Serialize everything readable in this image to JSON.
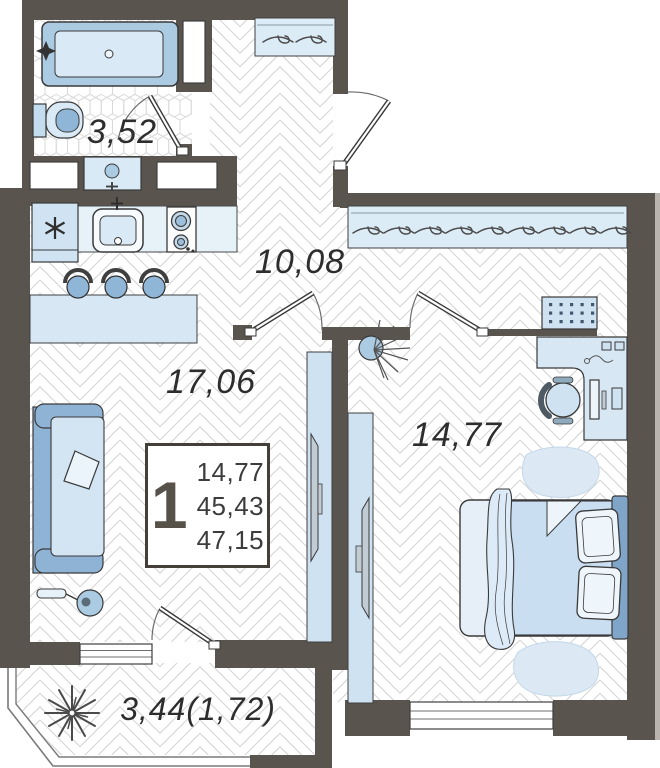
{
  "plan": {
    "rooms": [
      {
        "name": "bathroom",
        "area_label": "3,52"
      },
      {
        "name": "hallway",
        "area_label": "10,08"
      },
      {
        "name": "living-room",
        "area_label": "17,06"
      },
      {
        "name": "bedroom",
        "area_label": "14,77"
      },
      {
        "name": "balcony",
        "area_label": "3,44(1,72)"
      }
    ],
    "info_box": {
      "rooms_count": "1",
      "values": [
        "14,77",
        "45,43",
        "47,15"
      ]
    },
    "colors": {
      "wall": "#59544e",
      "furniture_light": "#cfe2f1",
      "furniture_lighter": "#e6eff8",
      "furniture_medium": "#8fb6d7",
      "accent": "#7fa6c8",
      "floor_line": "#d6d6d6",
      "text": "#2d2d2d"
    }
  }
}
